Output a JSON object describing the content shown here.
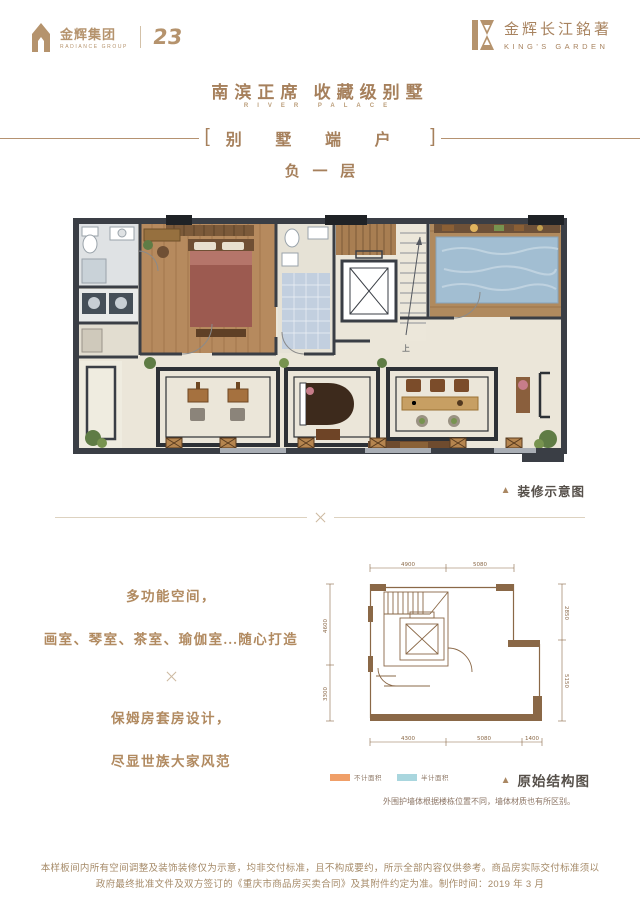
{
  "brand_left": {
    "name_cn": "金辉集团",
    "name_en": "RADIANCE GROUP",
    "anniversary": "23"
  },
  "brand_right": {
    "name_cn": "金辉长江銘著",
    "name_en": "KING'S GARDEN"
  },
  "header": {
    "title": "南滨正席  收藏级别墅",
    "title_en": "RIVER PALACE",
    "bracket_left": "[",
    "unit_banner": "别墅端户",
    "bracket_right": "]",
    "floor": "负一层"
  },
  "decorated_plan": {
    "caption_marker": "▲",
    "caption": "装修示意图",
    "stair_label": "上"
  },
  "features": {
    "line1": "多功能空间，",
    "line2": "画室、琴室、茶室、瑜伽室...随心打造",
    "line3": "保姆房套房设计，",
    "line4": "尽显世族大家风范"
  },
  "structure_plan": {
    "caption_marker": "▲",
    "caption": "原始结构图",
    "note": "外围护墙体根据楼栋位置不同，墙体材质也有所区别。",
    "legend": [
      {
        "label": "不计面积",
        "color": "#f09f68"
      },
      {
        "label": "半计面积",
        "color": "#a9d6de"
      }
    ],
    "dims_top": [
      "4900",
      "5080"
    ],
    "dims_bottom": [
      "4300",
      "5080",
      "1400"
    ],
    "dims_left": [
      "4600",
      "3300"
    ],
    "dims_right": [
      "2850",
      "5150"
    ]
  },
  "footer": {
    "line1": "本样板间内所有空间调整及装饰装修仅为示意，均非交付标准，且不构成要约，所示全部内容仅供参考。商品房实际交付标准须以",
    "line2": "政府最终批准文件及双方签订的《重庆市商品房买卖合同》及其附件约定为准。制作时间：2019 年 3 月"
  },
  "colors": {
    "brand_gold": "#b5936d",
    "title_brown": "#a6805c",
    "structure_brown": "#8a6847",
    "caption_dark": "#56504a"
  }
}
